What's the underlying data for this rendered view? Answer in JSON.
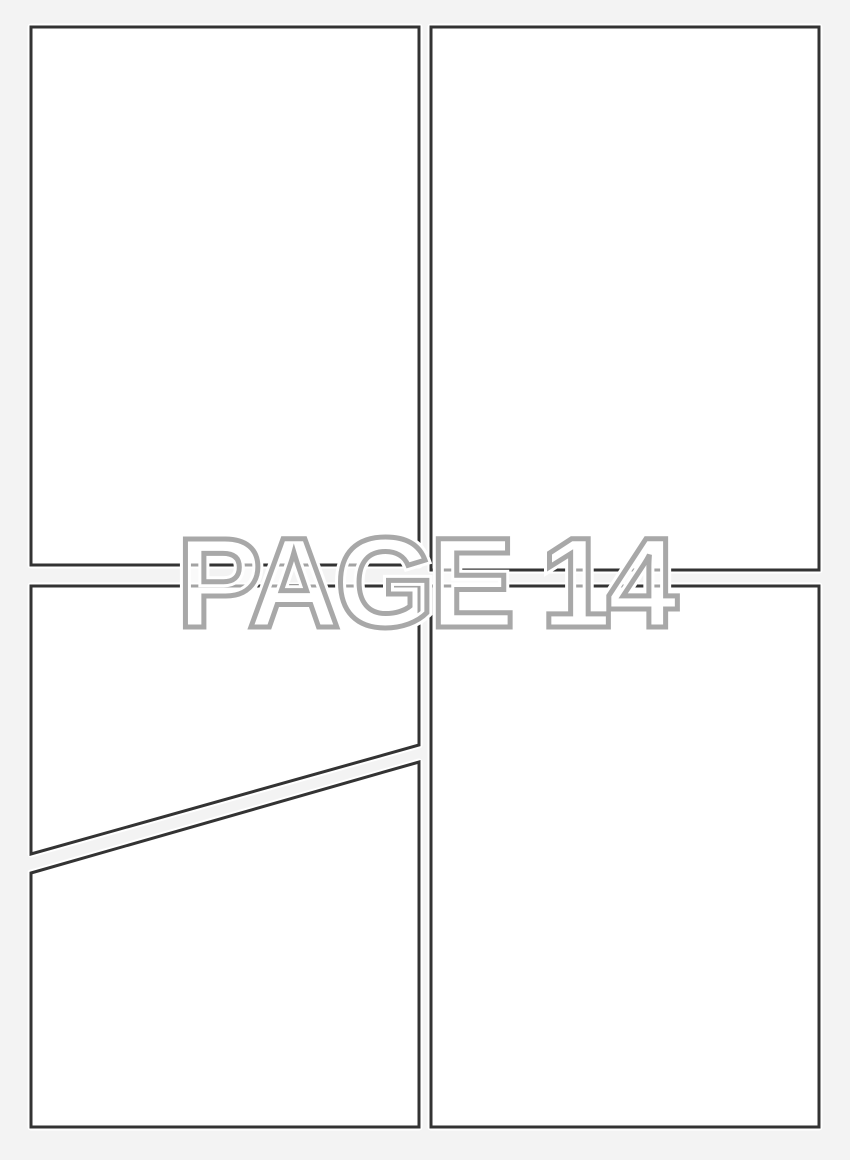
{
  "page": {
    "label": "PAGE 14",
    "background_color": "#f3f3f3",
    "panel_fill_color": "#ffffff",
    "panel_border_color": "#333333",
    "watermark_outline_color": "#a8a8a8",
    "watermark_halo_color": "#ffffff"
  },
  "panels": [
    {
      "name": "panel-top-left",
      "points": "31,27 419,27 419,565 31,565"
    },
    {
      "name": "panel-top-right",
      "points": "431,27 819,27 819,570 431,570"
    },
    {
      "name": "panel-middle-left",
      "points": "31,586 419,586 419,745 31,854"
    },
    {
      "name": "panel-bottom-left",
      "points": "31,873 419,762 419,1127 31,1127"
    },
    {
      "name": "panel-bottom-right",
      "points": "431,586 819,586 819,1127 431,1127"
    }
  ]
}
